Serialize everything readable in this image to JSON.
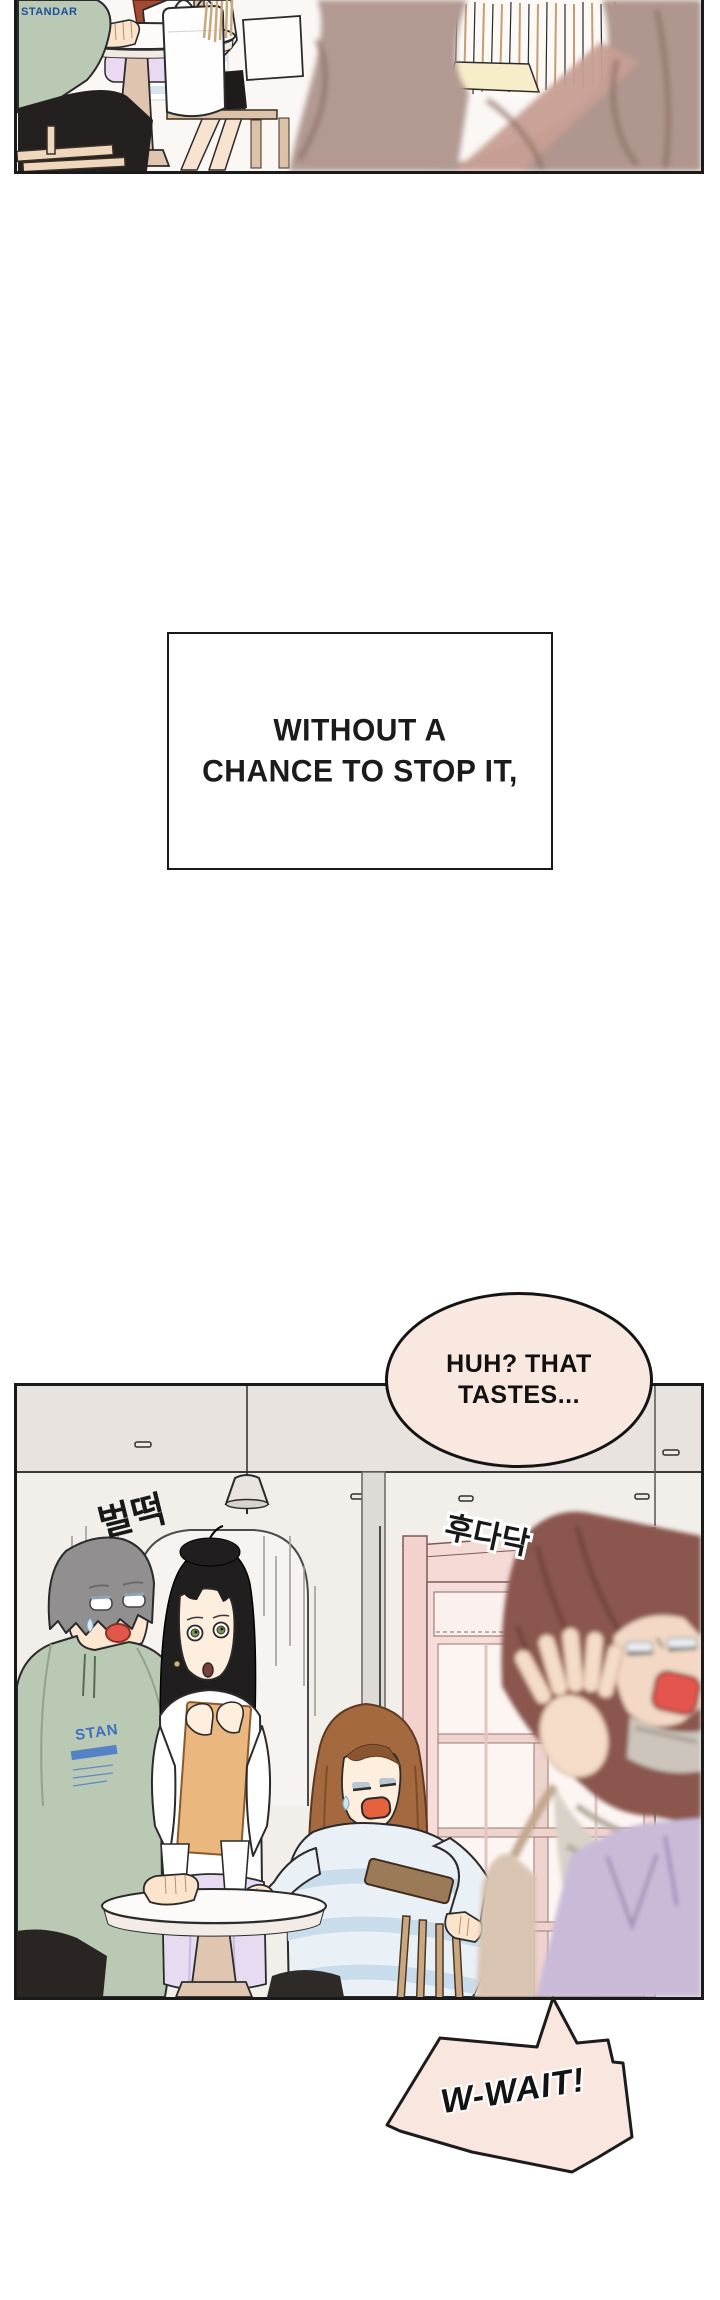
{
  "comic": {
    "caption": {
      "lines": [
        "WITHOUT A",
        "CHANCE TO STOP IT,"
      ]
    },
    "speech": {
      "huh_bubble": {
        "lines": [
          "HUH? THAT",
          "TASTES..."
        ],
        "fill": "#f9e8e0"
      },
      "wait_bubble": {
        "text": "W-WAIT!",
        "fill": "#f9e7df"
      }
    },
    "sfx": {
      "jump_up": "벌떡",
      "scurry": "후다닥"
    },
    "prints": {
      "poster": "STANDAR",
      "hoodie": "STAN"
    },
    "colors": {
      "panel_border": "#1a1a1a",
      "wall": "#f2eeea",
      "ceiling": "#e8e3df",
      "door_pink": "#f3d6d2",
      "hoodie_green": "#b9c9b3",
      "skirt_lavender": "#e7dbf1",
      "apron_lavender": "#c9bbd8",
      "seated_hair_brown": "#a5693f",
      "rushing_hair_auburn": "#8a564e",
      "sweater_stripe_blue": "#cfdfee",
      "mouth_red": "#e4564d"
    }
  }
}
